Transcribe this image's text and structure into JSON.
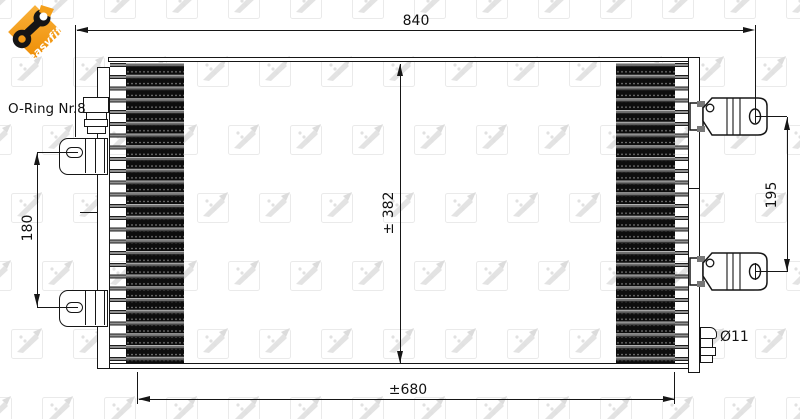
{
  "drawing": {
    "logo": {
      "text": "easyfit"
    },
    "watermark_brand": "NRF",
    "labels": {
      "oring": "O-Ring Nr.8",
      "diameter": "Ø11",
      "dim_total_width": "840",
      "dim_height": "± 382",
      "dim_core_width": "±680",
      "dim_left_mounts": "180",
      "dim_right_mounts": "195"
    },
    "colors": {
      "accent_orange": "#f39a14",
      "line": "#161616",
      "fin_dark": "#0d0d0d",
      "watermark_gray": "#e6e6e6"
    }
  }
}
